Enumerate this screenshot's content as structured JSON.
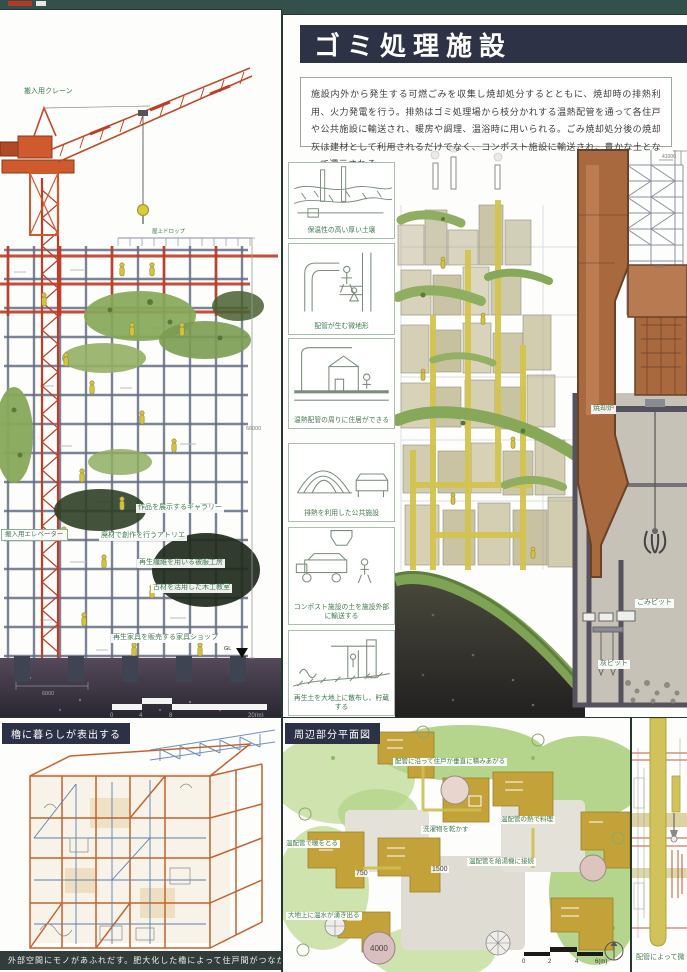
{
  "poster": {
    "background": "#33504a",
    "accent_navy": "#2e3247",
    "label_green": "#3f7a4e",
    "crane_orange": "#c8502c",
    "incinerator_brown": "#a9693f"
  },
  "left_panel": {
    "crane_label": "搬入用クレーン",
    "roof_label": "屋上ドロップ",
    "elevator_label": "搬入用エレベーター",
    "floor_labels": [
      "作品を展示するギャラリー",
      "廃材で創作を行うアトリエ",
      "再生繊維を用いる被服工房",
      "古材を活用した木工教室",
      "再生家具を販売する家具ショップ"
    ],
    "gl_label": "GL",
    "height_dim": "66000",
    "width_dim": "6000",
    "scale_ticks": [
      "0",
      "4",
      "8",
      "20(m)"
    ]
  },
  "waste_panel": {
    "title": "ゴミ処理施設",
    "description": "施設内外から発生する可燃ごみを収集し焼却処分するとともに、焼却時の排熱利用、火力発電を行う。排熱はゴミ処理場から枝分かれする温熱配管を通って各住戸や公共施設に輸送され、暖房や調理、温浴時に用いられる。ごみ焼却処分後の焼却灰は建材として利用されるだけでなく、コンポスト施設に輸送され、豊かな土となって還元される。",
    "diagrams": [
      {
        "caption": "保温性の高い厚い土壌"
      },
      {
        "caption": "配管が生む微地形"
      },
      {
        "caption": "温熱配管の周りに住居ができる"
      },
      {
        "caption": "排熱を利用した公共施設"
      },
      {
        "caption": "コンポスト施設の土を施設外部に輸送する"
      },
      {
        "caption": "再生土を大地上に散布し、貯蔵する"
      }
    ],
    "incinerator_label": "焼却炉",
    "waste_pit_label": "ごみピット",
    "ash_pit_label": "灰ピット",
    "dim_top_right": "41000",
    "dim_small": "1300"
  },
  "yagura_panel": {
    "title": "櫓に暮らしが表出する",
    "caption": "外部空間にモノがあふれだす。肥大化した櫓によって住戸間がつながっていく。"
  },
  "plan_panel": {
    "title": "周辺部分平面図",
    "labels": [
      "配管に沿って住戸が垂直に積みあがる",
      "温配管の熱で料理",
      "洗濯物を乾かす",
      "温配管で暖をとる",
      "温配管を給湯機に接続",
      "大地上に温水が湧き出る"
    ],
    "dims": [
      "750",
      "1500",
      "4000"
    ],
    "scale_ticks": [
      "0",
      "2",
      "4",
      "6(m)"
    ]
  },
  "pipe_panel": {
    "caption": "配管によって微"
  }
}
